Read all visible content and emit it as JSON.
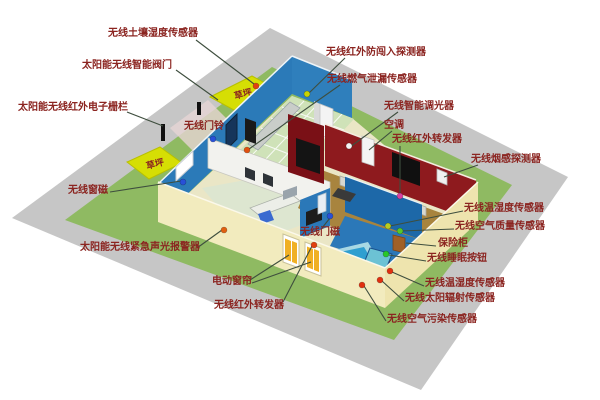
{
  "diagram": {
    "description": "isometric smart-home wireless sensor layout",
    "lawn_label": "草坪",
    "colors": {
      "yard_green": "#8fba62",
      "pavement_gray": "#c6c6c6",
      "lawn_patch_yellow": "#d6de04",
      "outer_wall_cream": "#f2ebbe",
      "rear_wall_blue": "#2b7ab8",
      "living_wall_red": "#8e1a1e",
      "living_floor_brown": "#a8843e",
      "kitchen_floor_green": "#cfe2b8",
      "pool_blue": "#2f9fd0",
      "label_text": "#8b2420",
      "leader_line": "#3e4e3e",
      "dot_red": "#e04010",
      "dot_orange": "#e06010",
      "dot_blue": "#2850d8",
      "dot_green": "#28c828",
      "dot_yellow": "#c8d400",
      "dot_magenta": "#d840a0"
    },
    "labels": [
      {
        "id": "soil-moisture-sensor",
        "text": "无线土壤湿度传感器"
      },
      {
        "id": "smart-valve",
        "text": "太阳能无线智能阀门"
      },
      {
        "id": "infrared-electronic-fence",
        "text": "太阳能无线红外电子栅栏"
      },
      {
        "id": "doorbell",
        "text": "无线门铃"
      },
      {
        "id": "window-magnet",
        "text": "无线窗磁"
      },
      {
        "id": "emergency-sound-light-alarm",
        "text": "太阳能无线紧急声光报警器"
      },
      {
        "id": "electric-curtain",
        "text": "电动窗帘"
      },
      {
        "id": "ir-repeater-front",
        "text": "无线红外转发器"
      },
      {
        "id": "intrusion-detector",
        "text": "无线红外防闯入探测器"
      },
      {
        "id": "gas-leak-sensor",
        "text": "无线燃气泄漏传感器"
      },
      {
        "id": "smart-dimmer",
        "text": "无线智能调光器"
      },
      {
        "id": "air-conditioner",
        "text": "空调"
      },
      {
        "id": "ir-repeater-living",
        "text": "无线红外转发器"
      },
      {
        "id": "smoke-detector",
        "text": "无线烟感探测器"
      },
      {
        "id": "temp-humidity-sensor-1",
        "text": "无线温湿度传感器"
      },
      {
        "id": "air-quality-sensor",
        "text": "无线空气质量传感器"
      },
      {
        "id": "safe-box",
        "text": "保险柜"
      },
      {
        "id": "sleep-button",
        "text": "无线睡眠按钮"
      },
      {
        "id": "temp-humidity-sensor-2",
        "text": "无线温湿度传感器"
      },
      {
        "id": "solar-radiation-sensor",
        "text": "无线太阳辐射传感器"
      },
      {
        "id": "air-pollution-sensor",
        "text": "无线空气污染传感器"
      },
      {
        "id": "door-magnet",
        "text": "无线门磁"
      }
    ]
  }
}
